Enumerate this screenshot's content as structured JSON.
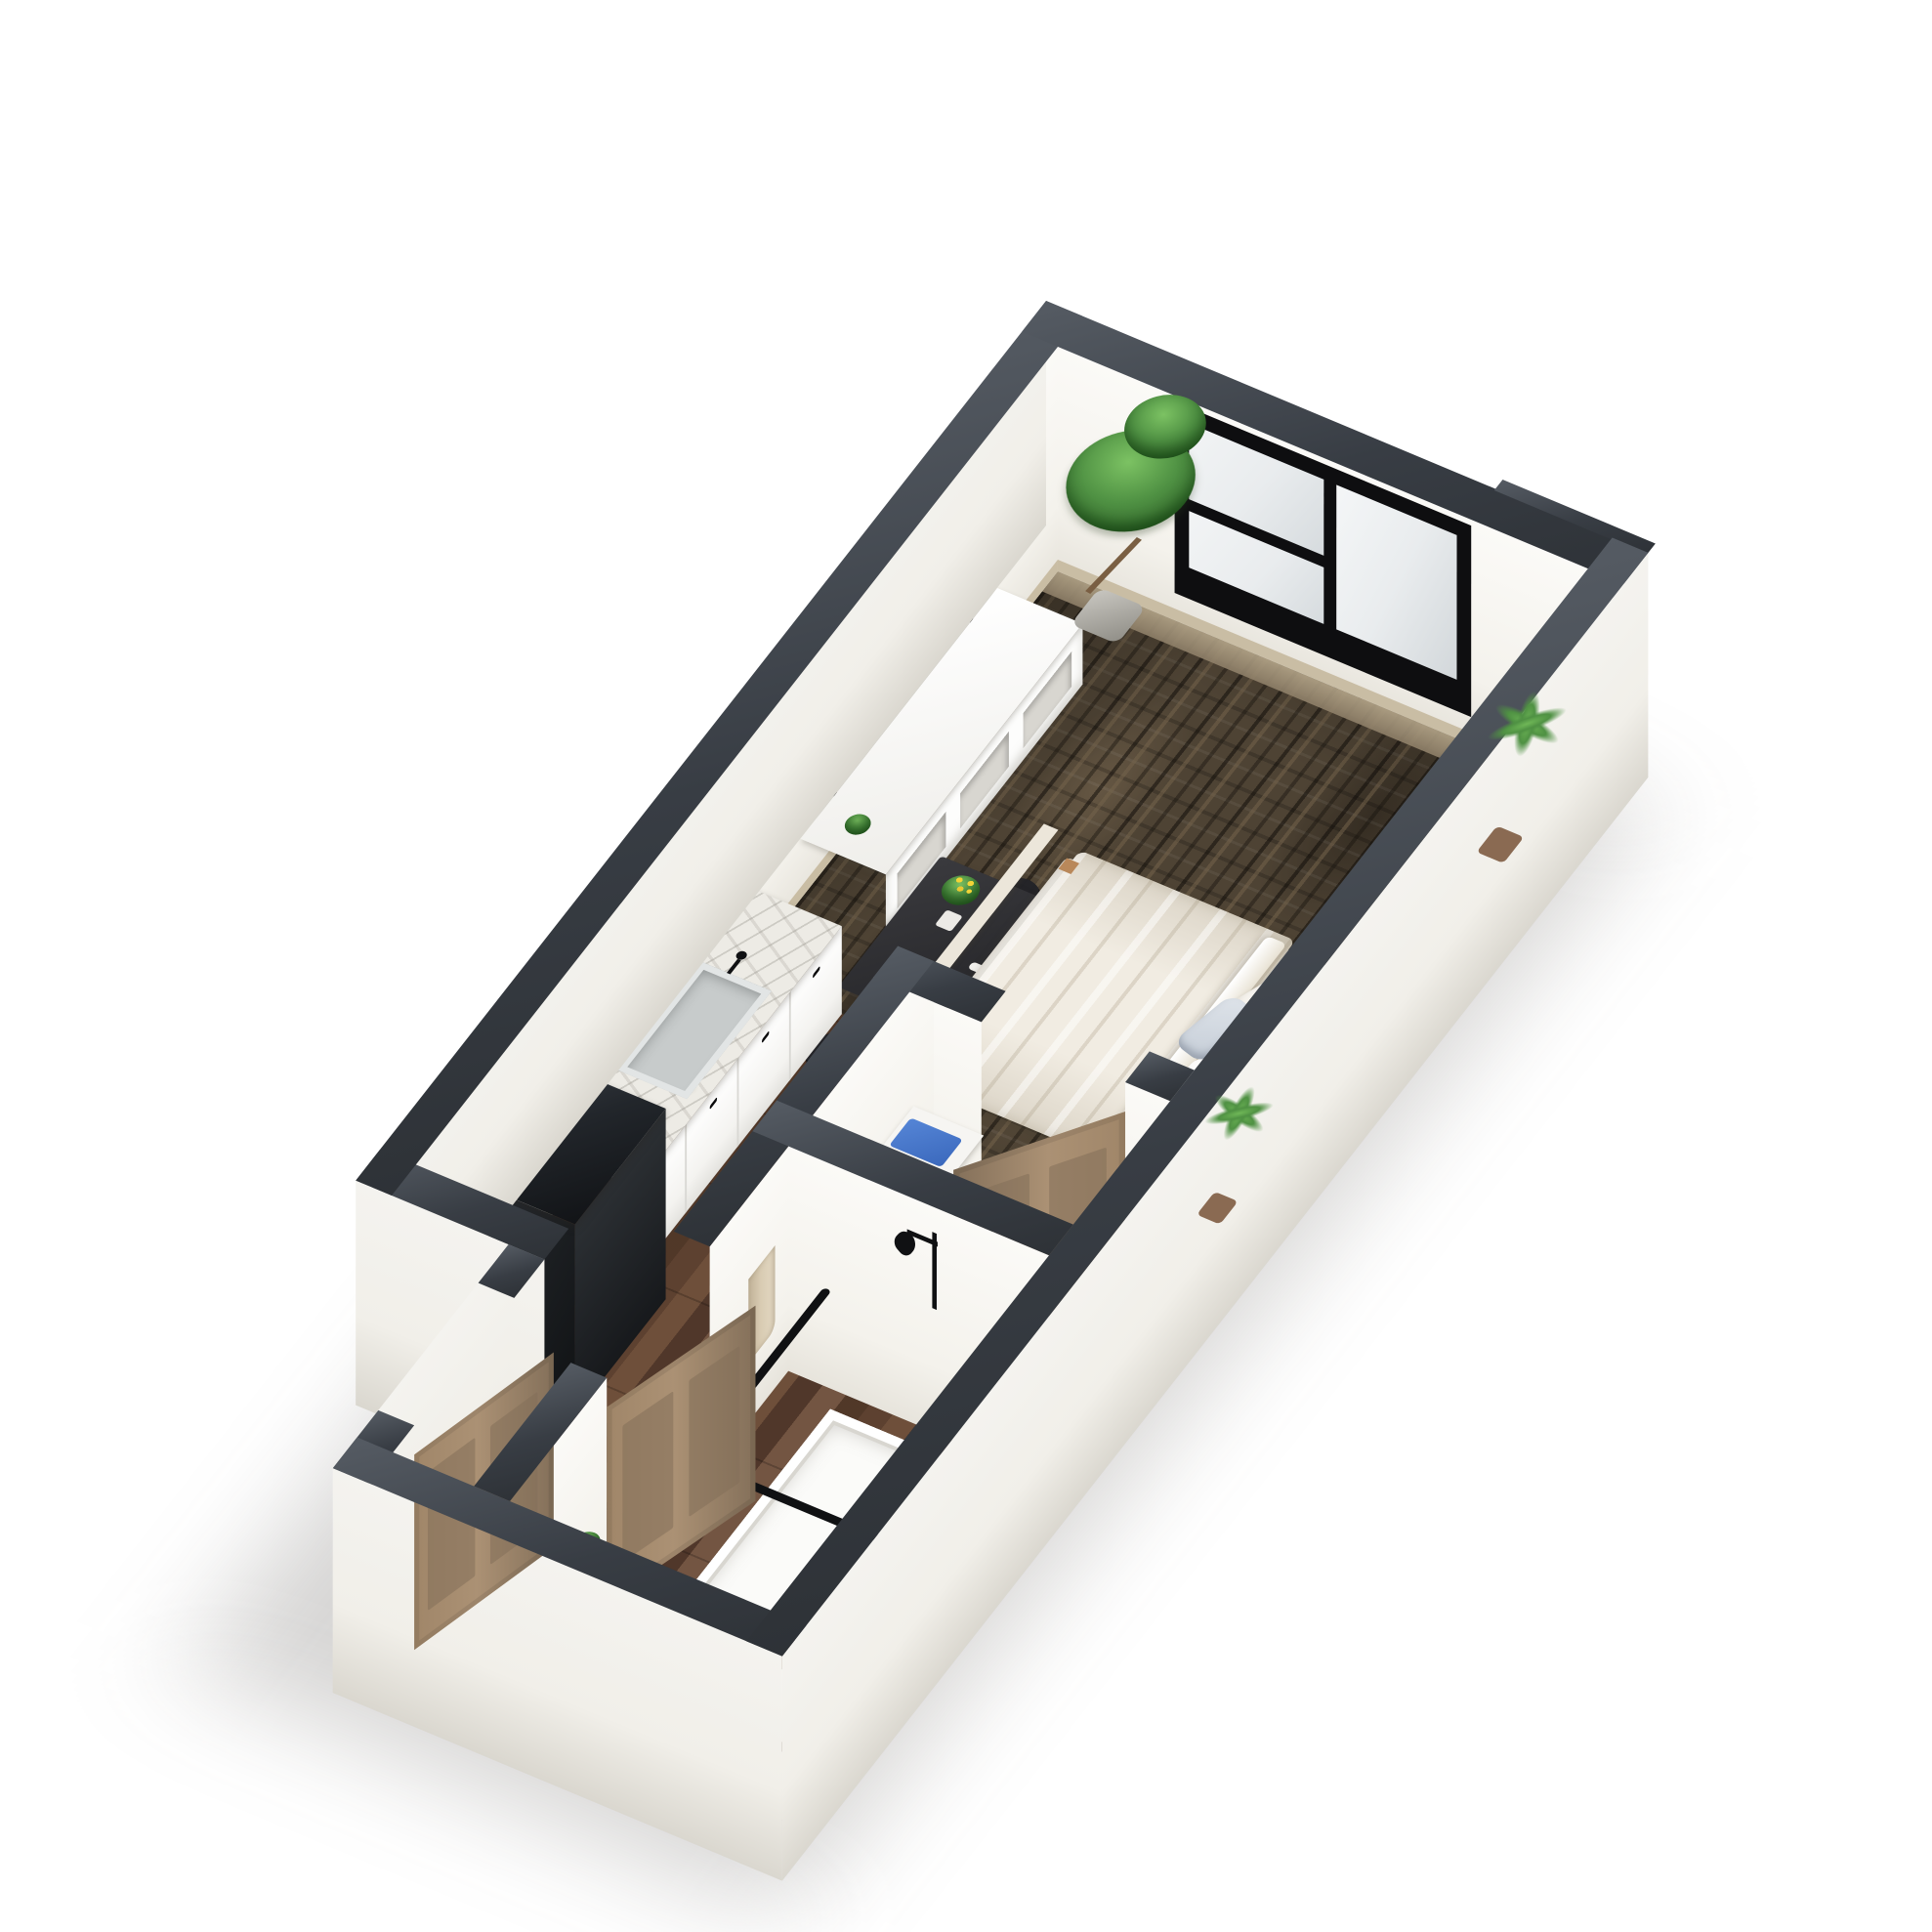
{
  "app": {
    "title": "3D studio apartment floor plan rendering",
    "visible_text": []
  },
  "palette": {
    "bg": "#ffffff",
    "wall-top": "#383d44",
    "wall-top-light": "#555b63",
    "wall-face": "#fbfaf7",
    "wall-face-shade": "#e7e4dc",
    "wall-exterior": "#f1efe9",
    "baseboard": "#c9bda4",
    "carpet": "#4e4334",
    "carpet-dark": "#262019",
    "carpet-light": "#74634b",
    "wood": "#5e4230",
    "wood-dark": "#3f2c20",
    "wood-light": "#7a5941",
    "floor-light": "#e5e0d6",
    "marble": "#edebe5",
    "marble-vein": "#b9b6ad",
    "cabinet": "#fbfbfa",
    "cabinet-shade": "#e4e3df",
    "fridge": "#212428",
    "fridge-light": "#41464d",
    "door": "#a08669",
    "door-dark": "#84705a",
    "table": "#2c2c2f",
    "chair": "#242428",
    "bed-sheet": "#fcfbf8",
    "duvet": "#f1ece2",
    "pillow-blue": "#c5cdd7",
    "green": "#4f9143",
    "green-dark": "#2f6328",
    "pot-gray": "#b5b2ab",
    "pot-brown": "#8a6a52",
    "towel": "#d8cbb2",
    "blue-towel": "#3b69bd",
    "navy": "#2e4a7a",
    "fixture": "#101113",
    "window-frame": "#0e0e10",
    "window-pane": "#e9ecee",
    "shelf-cream": "#e6ddc9"
  },
  "scene": {
    "type": "3d-floor-plan-render",
    "projection": "plan-oblique",
    "rooms": [
      {
        "name": "living-sleeping-area",
        "floor": "patterned-carpet"
      },
      {
        "name": "kitchen-run",
        "floor": "dark-wood-plank"
      },
      {
        "name": "entry-hall",
        "floor": "dark-wood-plank"
      },
      {
        "name": "closet",
        "floor": "light"
      },
      {
        "name": "bathroom",
        "floor": "dark-wood-plank"
      }
    ],
    "furniture": [
      "black-framed-window",
      "wall-mounted-tv",
      "white-media-console",
      "cream-wall-shelf",
      "tall-potted-tree",
      "potted-palm",
      "queen-bed-white-bedding",
      "throw-pillows",
      "wood-nightstand",
      "black-dining-table",
      "black-dining-chairs",
      "yellow-flower-vase",
      "white-upper-cabinets",
      "marble-kitchen-counter",
      "undermount-sink",
      "black-refrigerator",
      "plant-on-refrigerator",
      "linen-shelf-blue-towels",
      "brown-closet-door",
      "walk-in-shower",
      "black-grab-bars",
      "black-shower-head",
      "hanging-towel",
      "brown-bathroom-door",
      "marble-vanity",
      "round-vessel-sink",
      "toilet",
      "brown-entry-door"
    ]
  }
}
